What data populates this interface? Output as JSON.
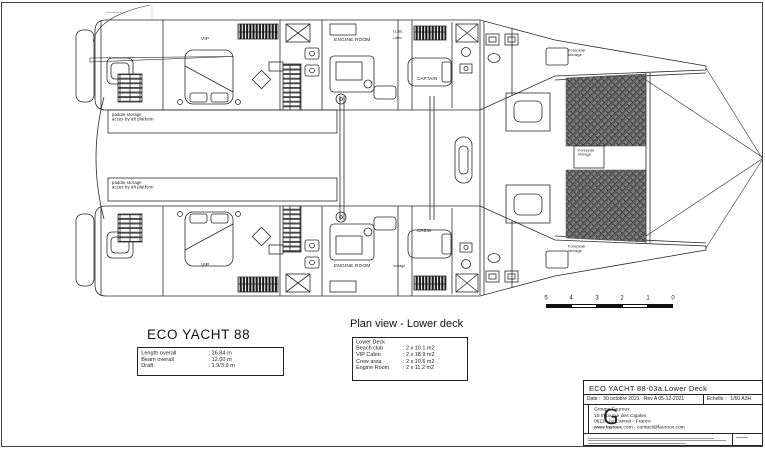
{
  "drawing": {
    "labels": {
      "vip_top": "VIP",
      "engine_room_top": "ENGINE ROOM",
      "linen_code": "LL.BL",
      "linen": "Linen",
      "captain": "CAPTAIN",
      "forepeak_top": "Forepeak\nstorage",
      "paddle_storage_1": "paddle storage\nacces by aft platform",
      "paddle_storage_2": "paddle storage\nacces by aft platform",
      "forepeak_center": "Forepeak\nstorage",
      "vip_bottom": "VIP",
      "engine_room_bottom": "ENGINE ROOM",
      "storage_bottom": "Storage",
      "crew": "CREW",
      "forepeak_bottom": "Forepeak\nstorage"
    },
    "scale_bar": {
      "labels": [
        "5",
        "4",
        "3",
        "2",
        "1",
        "0"
      ]
    },
    "colors": {
      "line": "#2a2a2a",
      "trampoline_fill": "#7d7d7d",
      "trampoline_hatch": "#5e5e5e"
    }
  },
  "specs": {
    "title": "ECO YACHT 88",
    "rows": [
      {
        "label": "Length overall",
        "value": ": 26.84 m"
      },
      {
        "label": "Beam overall",
        "value": ": 12.00 m"
      },
      {
        "label": "Draft",
        "value": ": 1.9/3.9 m"
      }
    ]
  },
  "plan_view": {
    "heading": "Plan view - Lower deck",
    "table_title": "Lower Deck",
    "rows": [
      {
        "label": "Beach club",
        "value": ": 2 x 10.1 m2"
      },
      {
        "label": "VIP Cabin",
        "value": ": 2 x 18.9 m2"
      },
      {
        "label": "Crew area",
        "value": ": 2 x 10.6 m2"
      },
      {
        "label": "Engine Room",
        "value": ": 2 x 11.2 m2"
      }
    ]
  },
  "title_block": {
    "doc_title": "ECO YACHT 88-03a.Lower Deck",
    "date_label": "Date :",
    "date_value": "30 octobre 2021",
    "revision": "Rev A 05-12-2021",
    "scale_label": "Echelle :",
    "scale_value": "1/60 A3H",
    "logo_letter": "G",
    "logo_caption": "Groupe Fauroux",
    "company_name": "Groupe Fauroux",
    "address_line1": "10 Impasse des Cigales",
    "address_line2": "06110 Le Cannet - France",
    "contact": "www.fauroux.com - contact@fauroux.com"
  }
}
